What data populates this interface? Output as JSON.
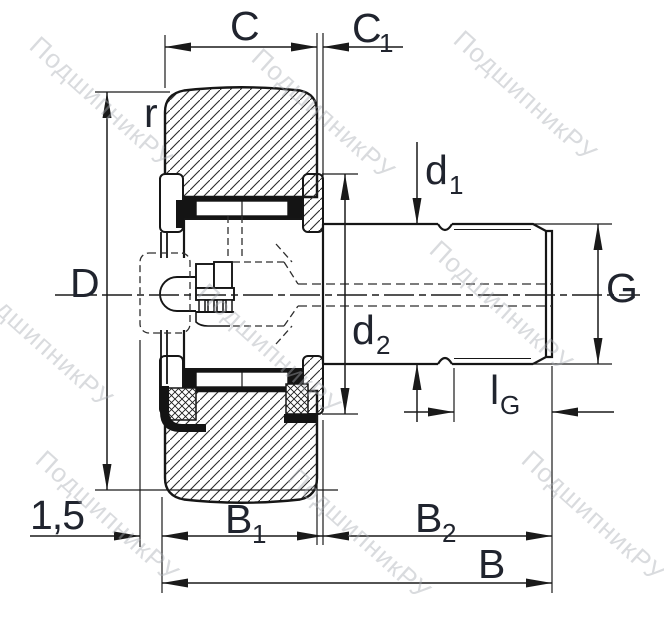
{
  "watermark": {
    "text": "ПодшипникРУ"
  },
  "dimensions": {
    "C": {
      "base": "C",
      "sub": ""
    },
    "C1": {
      "base": "C",
      "sub": "1"
    },
    "r": {
      "base": "r",
      "sub": ""
    },
    "D": {
      "base": "D",
      "sub": ""
    },
    "d1": {
      "base": "d",
      "sub": "1"
    },
    "d2": {
      "base": "d",
      "sub": "2"
    },
    "G": {
      "base": "G",
      "sub": ""
    },
    "lG": {
      "base": "l",
      "sub": "G"
    },
    "B1": {
      "base": "B",
      "sub": "1"
    },
    "B2": {
      "base": "B",
      "sub": "2"
    },
    "B": {
      "base": "B",
      "sub": ""
    },
    "chamfer": {
      "base": "1,5",
      "sub": ""
    }
  }
}
